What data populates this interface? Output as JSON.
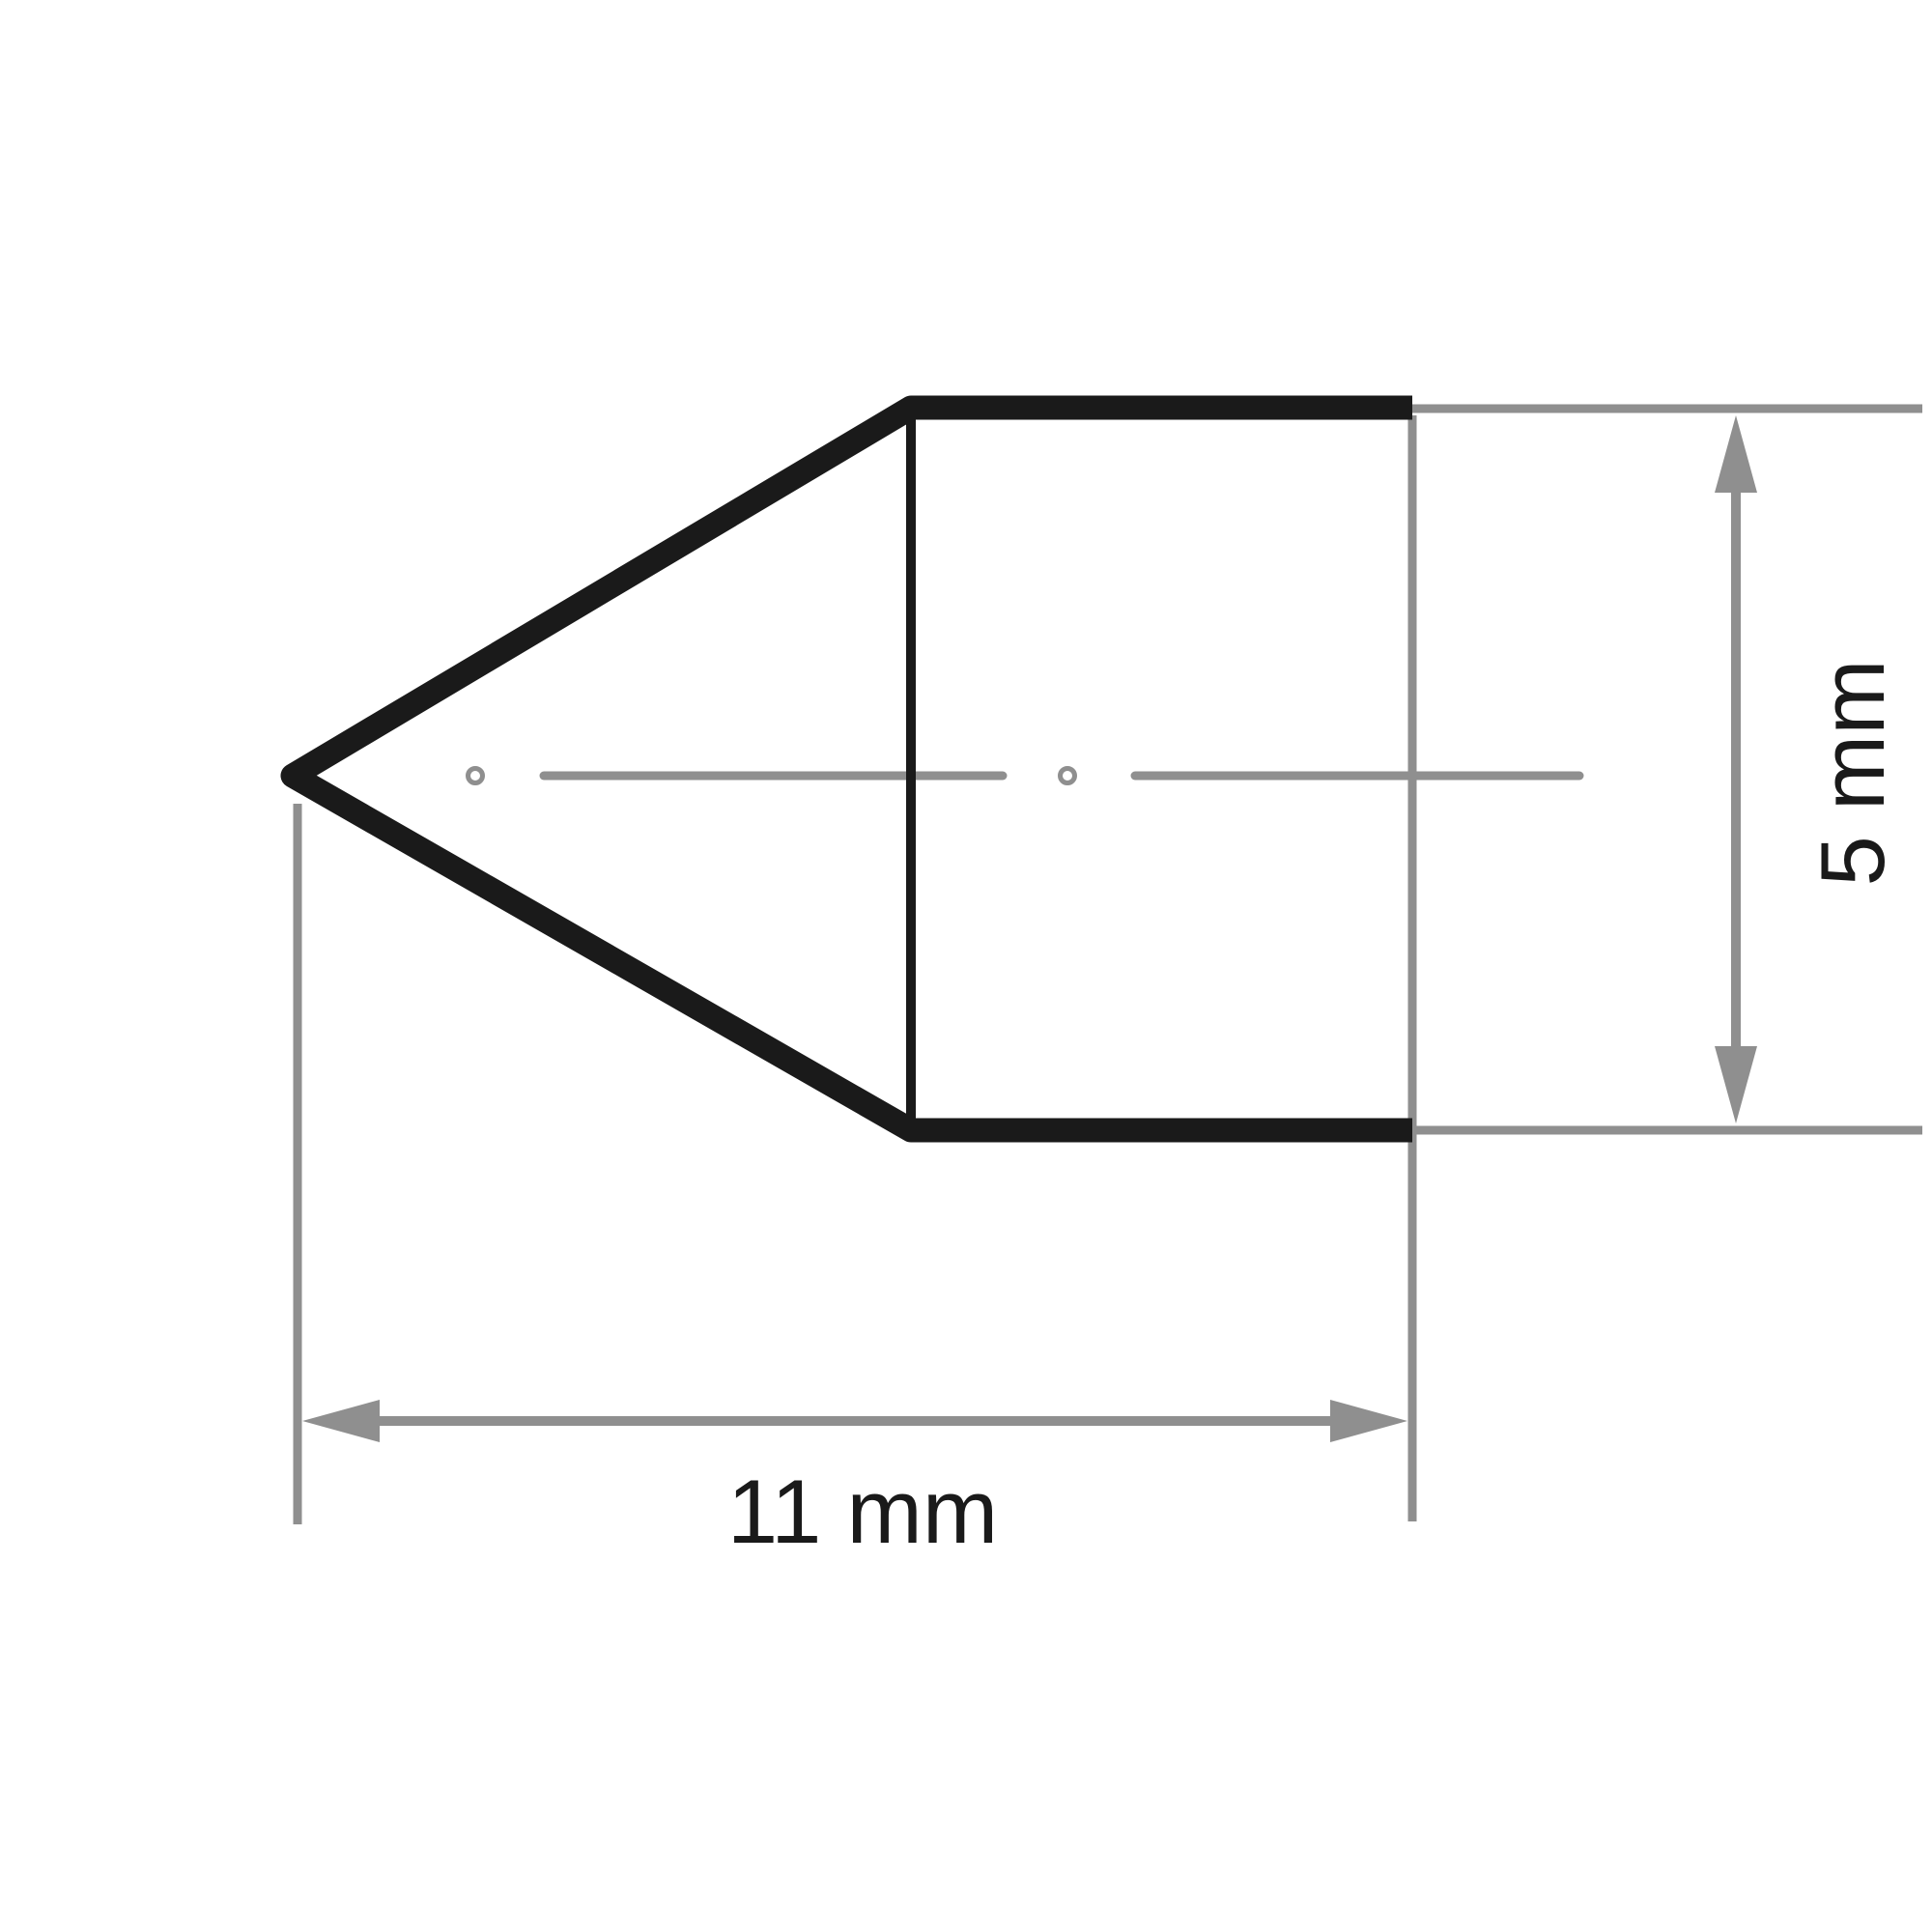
{
  "drawing": {
    "kind": "dimensioned technical drawing of a pointed (cone-nosed) cylindrical part, side view",
    "labels": {
      "width_dimension": "11 mm",
      "height_dimension": "5 mm"
    },
    "colors": {
      "outline": "#1a1a1a",
      "lines": "#8f8f8f",
      "text": "#1a1a1a",
      "background": "#ffffff"
    }
  }
}
